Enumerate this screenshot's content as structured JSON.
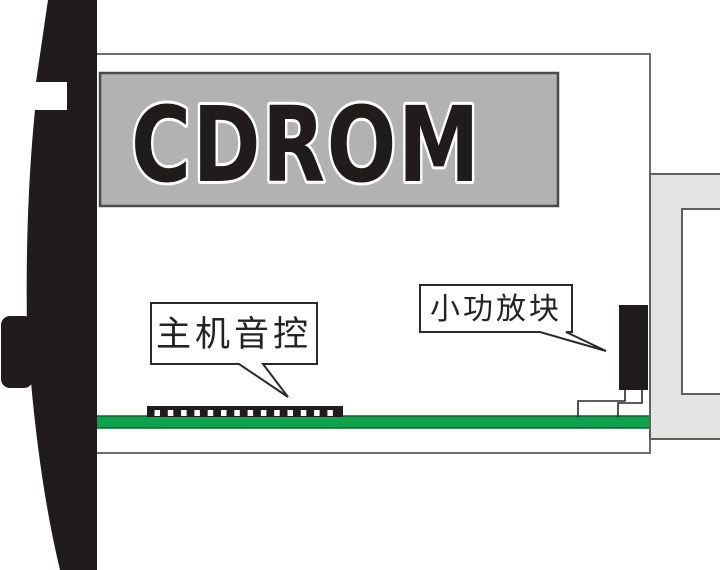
{
  "diagram": {
    "title": "CDROM drive side-view schematic",
    "device_label": "CDROM",
    "callouts": [
      {
        "text": "主机音控",
        "target": "host-audio-control-connector"
      },
      {
        "text": "小功放块",
        "target": "small-amplifier-block"
      }
    ],
    "connector": {
      "pin_count": 14
    },
    "colors": {
      "panel_gray": "#b2b2b2",
      "panel_border": "#4a4a48",
      "body_border": "#6e6e6c",
      "bracket_gray": "#e4e4e2",
      "bracket_border": "#5f5f5d",
      "pcb_green": "#0ea24c",
      "pcb_border": "#086231",
      "ink_black": "#201c1b"
    }
  }
}
